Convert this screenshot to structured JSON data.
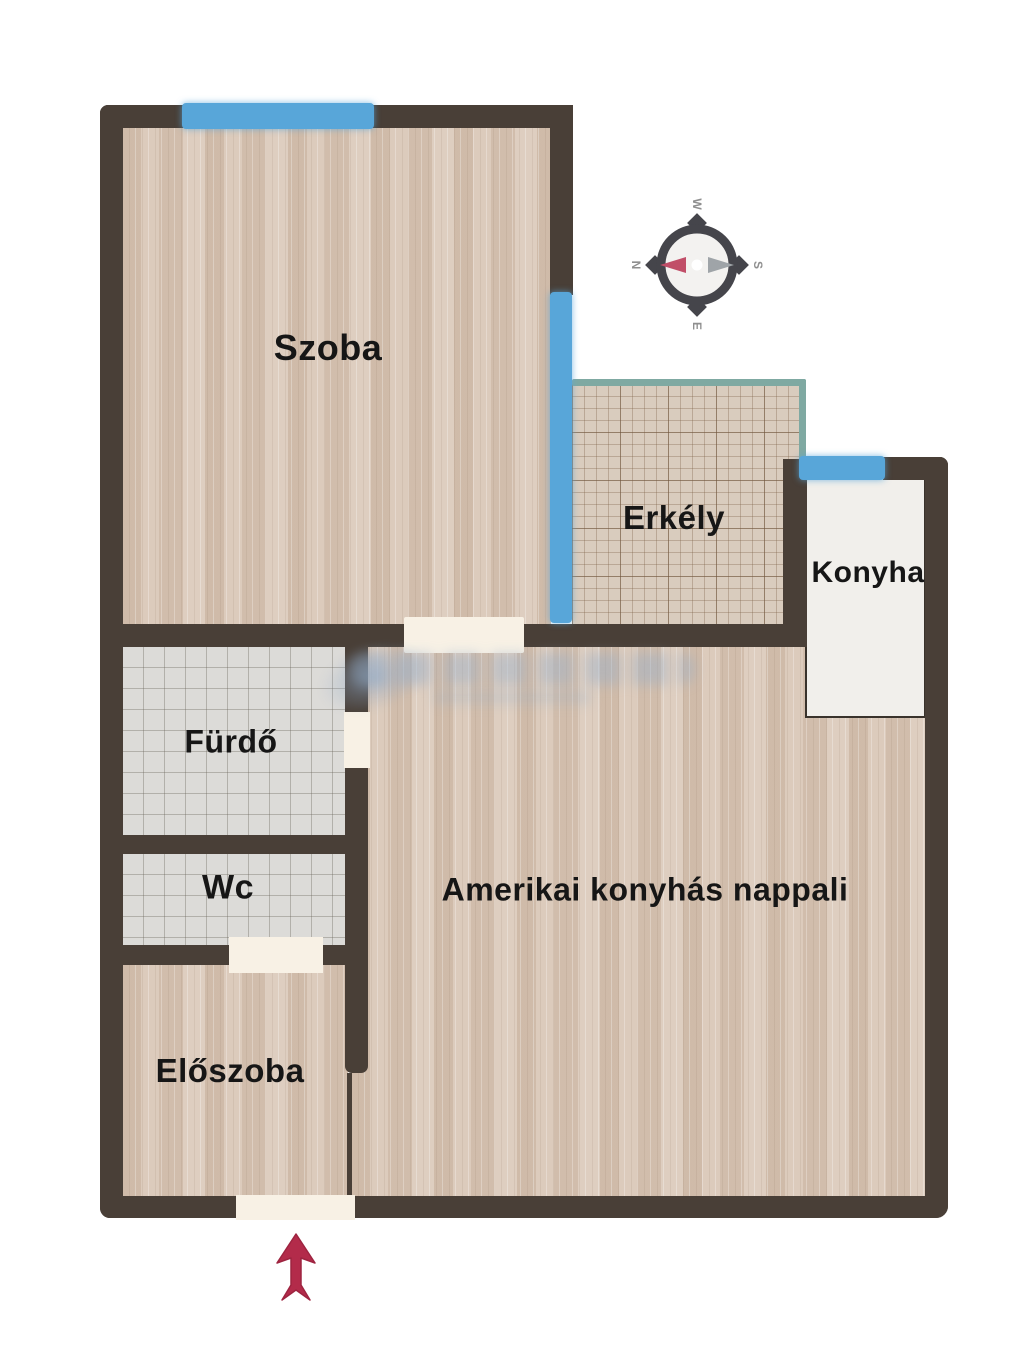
{
  "floorplan": {
    "rooms": {
      "szoba": {
        "label": "Szoba"
      },
      "erkely": {
        "label": "Erkély"
      },
      "konyha": {
        "label": "Konyha"
      },
      "furdo": {
        "label": "Fürdő"
      },
      "wc": {
        "label": "Wc"
      },
      "eloszoba": {
        "label": "Előszoba"
      },
      "nappali": {
        "label": "Amerikai konyhás nappali"
      }
    },
    "compass": {
      "top": "W",
      "left": "N",
      "right": "S",
      "bottom": "E"
    },
    "colors": {
      "wall": "#493f37",
      "window": "#58a6d9",
      "balcony_railing": "#7fa9a2",
      "wood_floor": "#d8c5b4",
      "tile_floor": "#dcdbd8",
      "balcony_floor": "#d9ccbe",
      "kitchen_floor": "#f1efeb",
      "door_opening": "#f8f1e5",
      "entrance_arrow": "#b32b4a",
      "compass_needle_red": "#c14e68",
      "compass_needle_gray": "#9fa4a8"
    }
  }
}
